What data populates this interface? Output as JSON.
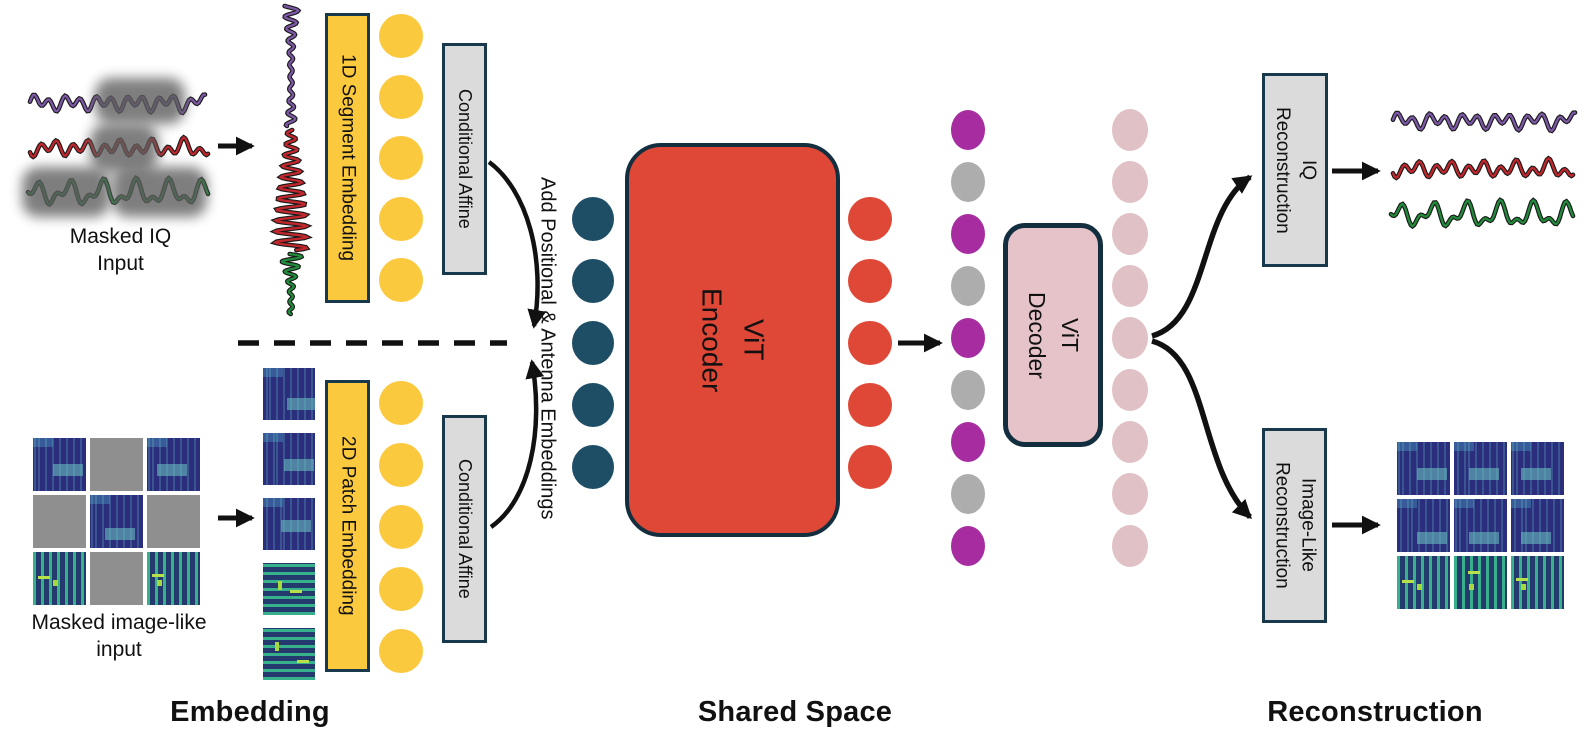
{
  "colors": {
    "yellow": "#FBC93E",
    "teal": "#1E4E66",
    "red": "#DF4736",
    "purple": "#A62CA0",
    "gray_token": "#ADADAD",
    "pink_token": "#E0C1C5",
    "pink_box": "#E5C3C9",
    "gray_box": "#DBDBDB",
    "outline": "#17394B",
    "arrow": "#111111",
    "wave_purple": "#7D58A6",
    "wave_red": "#C1272D",
    "wave_green": "#218B3B"
  },
  "embedding": {
    "iq_branch": {
      "input_label_line1": "Masked IQ",
      "input_label_line2": "Input",
      "embed_box_label": "1D Segment Embedding",
      "affine_box_label": "Conditional Affine"
    },
    "image_branch": {
      "input_label_line1": "Masked image-like",
      "input_label_line2": "input",
      "embed_box_label": "2D Patch Embedding",
      "affine_box_label": "Conditional Affine"
    }
  },
  "shared_space": {
    "add_embeddings_label": "Add Positional & Antenna Embeddings",
    "encoder_label_line1": "ViT",
    "encoder_label_line2": "Encoder",
    "decoder_label_line1": "ViT",
    "decoder_label_line2": "Decoder"
  },
  "reconstruction": {
    "iq_box_line1": "IQ",
    "iq_box_line2": "Reconstruction",
    "image_box_line1": "Image-Like",
    "image_box_line2": "Reconstruction"
  },
  "section_labels": {
    "embedding": "Embedding",
    "shared_space": "Shared Space",
    "reconstruction": "Reconstruction"
  },
  "token_columns": {
    "iq_tokens": {
      "count": 5,
      "color": "yellow"
    },
    "image_tokens": {
      "count": 5,
      "color": "yellow"
    },
    "encoder_input_tokens": {
      "count": 5,
      "color": "teal"
    },
    "encoder_output_tokens": {
      "count": 5,
      "color": "red"
    },
    "decoder_input_tokens": {
      "count": 9,
      "pattern": [
        "purple",
        "gray",
        "purple",
        "gray",
        "purple",
        "gray",
        "purple",
        "gray",
        "purple"
      ]
    },
    "decoder_output_tokens": {
      "count": 9,
      "color": "pink"
    }
  },
  "grids": {
    "masked_input_grid": [
      [
        "b",
        "m",
        "b"
      ],
      [
        "m",
        "b",
        "m"
      ],
      [
        "g",
        "m",
        "g"
      ]
    ],
    "patch_column": [
      "b",
      "b",
      "b",
      "gh",
      "gh"
    ],
    "output_grid": [
      [
        "b",
        "b",
        "b"
      ],
      [
        "b",
        "b",
        "b"
      ],
      [
        "g",
        "g",
        "g"
      ]
    ],
    "legend": {
      "b": "spectrogram patch (blue)",
      "g": "spectrogram patch (green striped)",
      "gh": "spectrogram patch (green striped, horizontal)",
      "m": "masked patch (gray)"
    }
  }
}
